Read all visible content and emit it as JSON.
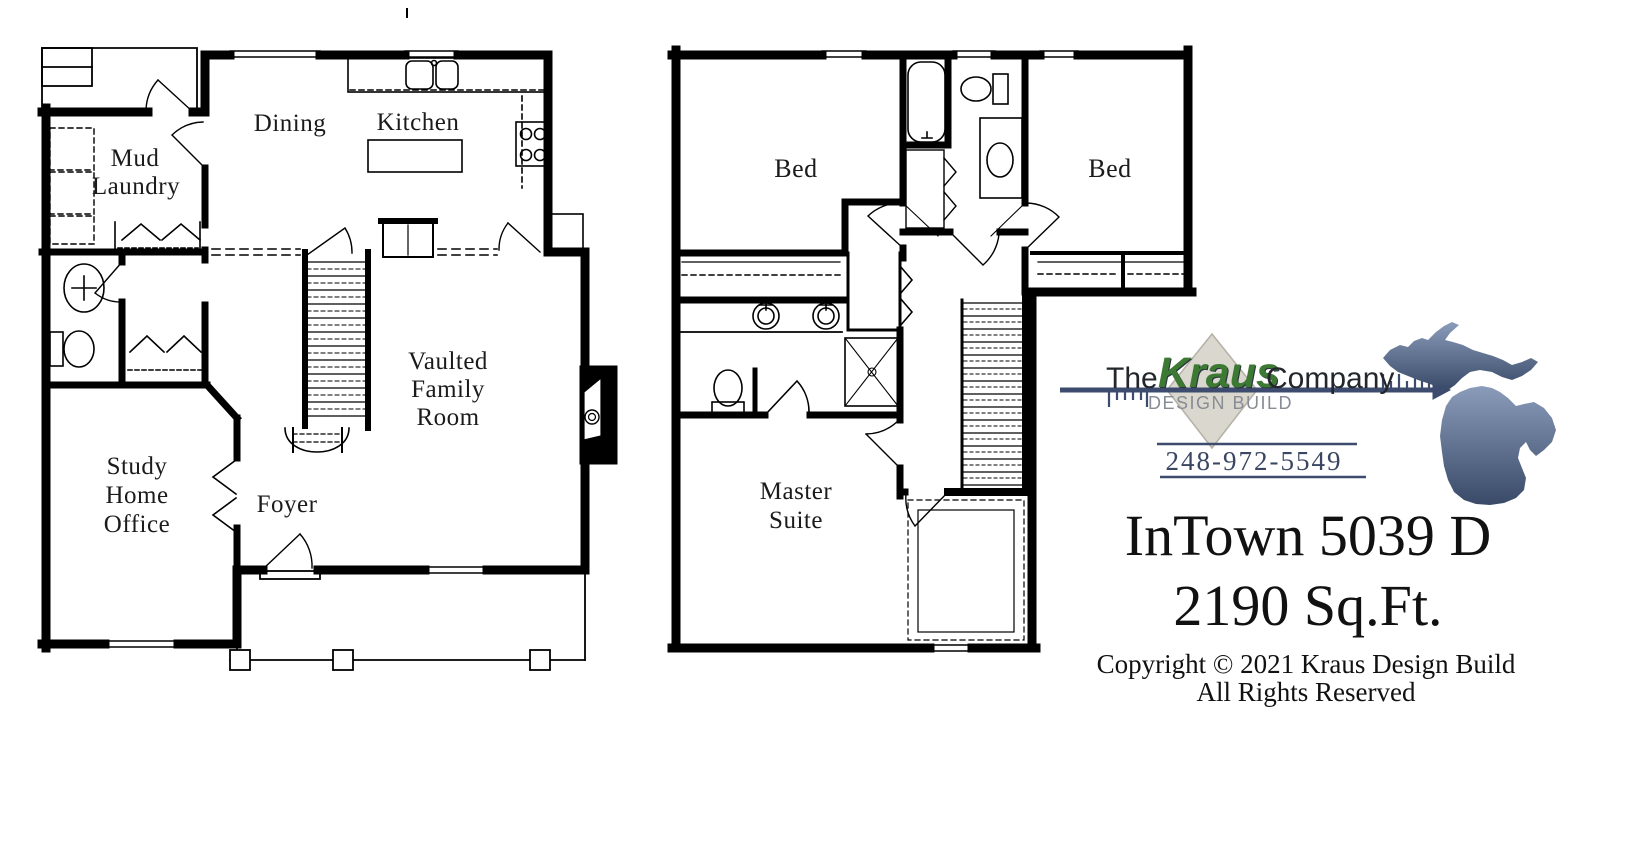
{
  "floor1": {
    "rooms": {
      "mud": [
        "Mud",
        "Laundry"
      ],
      "dining": "Dining",
      "kitchen": "Kitchen",
      "family": [
        "Vaulted",
        "Family",
        "Room"
      ],
      "study": [
        "Study",
        "Home",
        "Office"
      ],
      "foyer": "Foyer"
    }
  },
  "floor2": {
    "rooms": {
      "bed_left": "Bed",
      "bed_right": "Bed",
      "master": [
        "Master",
        "Suite"
      ]
    }
  },
  "brand": {
    "the": "The",
    "name": "Kraus",
    "company": "Company",
    "tagline": "DESIGN BUILD",
    "phone": "248-972-5549",
    "colors": {
      "kraus_green": "#3c7a33",
      "navy": "#3d4b6e",
      "diamond_gray": "#dad7ce",
      "tagline_gray": "#878c95",
      "michigan_light": "#8b9cbb",
      "michigan_dark": "#394a68"
    }
  },
  "plan": {
    "title": "InTown 5039 D",
    "area": "2190 Sq.Ft."
  },
  "copyright": {
    "line1": "Copyright © 2021 Kraus Design Build",
    "line2": "All Rights Reserved"
  }
}
